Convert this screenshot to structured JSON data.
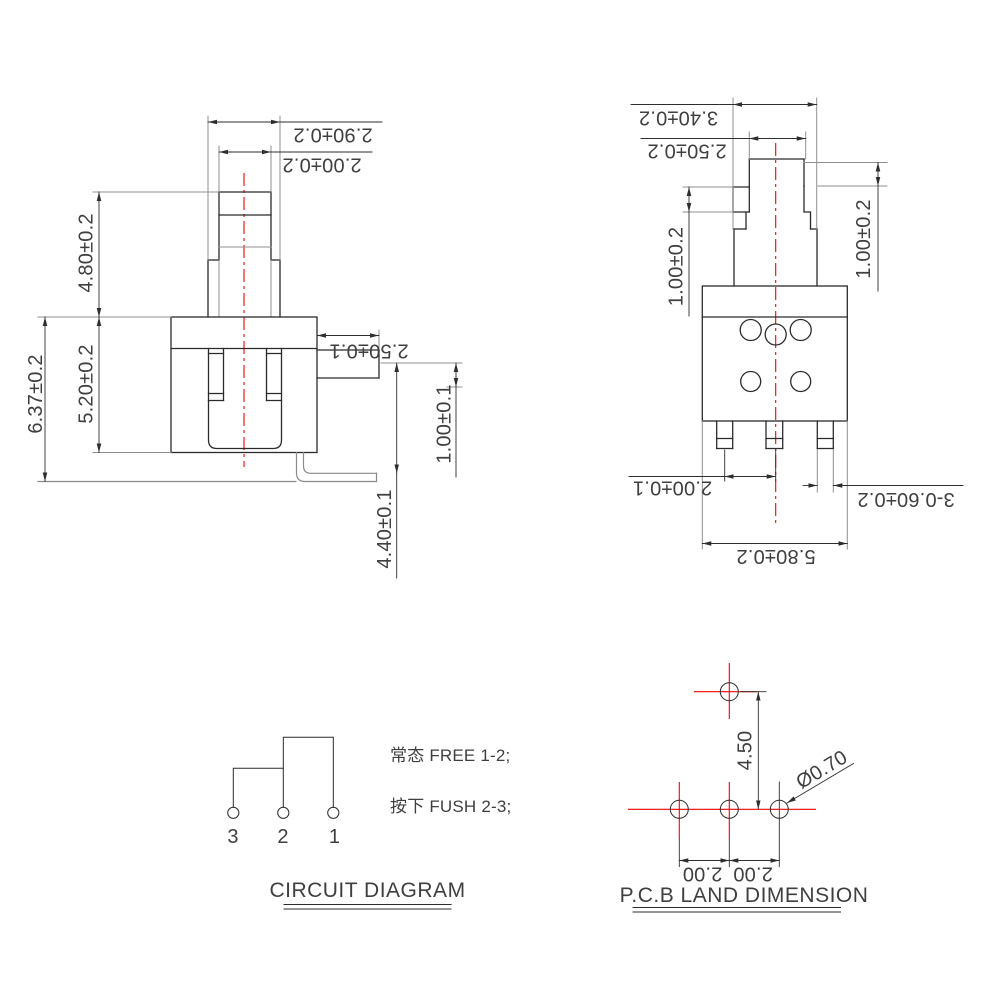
{
  "drawing": {
    "side_view": {
      "dim_plunger_outer_width": "2.90±0.2",
      "dim_plunger_inner_width": "2.00±0.2",
      "dim_plunger_height": "4.80±0.2",
      "dim_body_height": "5.20±0.2",
      "dim_total_height": "6.37±0.2",
      "dim_tab_length": "2.50±0.1",
      "dim_tab_offset": "1.00±0.1",
      "dim_lead_drop": "4.40±0.1"
    },
    "front_view": {
      "dim_boss_width": "3.40±0.2",
      "dim_cap_width": "2.50±0.2",
      "dim_cap_height_left": "1.00±0.2",
      "dim_cap_height_right": "1.00±0.2",
      "dim_pin_pitch": "2.00±0.1",
      "dim_pin_width": "3-0.60±0.2",
      "dim_body_width": "5.80±0.2"
    },
    "circuit_diagram": {
      "terminal_labels": [
        "3",
        "2",
        "1"
      ],
      "note_normal": "常态 FREE 1-2;",
      "note_pressed": "按下 FUSH 2-3;",
      "title": "CIRCUIT DIAGRAM"
    },
    "pcb_land": {
      "dim_row_pitch": "4.50",
      "dim_hole_diameter": "Ø0.70",
      "dim_pitch_left": "2.00",
      "dim_pitch_right": "2.00",
      "title": "P.C.B LAND DIMENSION"
    },
    "colors": {
      "outline": "#2b2b2b",
      "extension_line": "#8f8f8f",
      "centerline_red": "#f60200",
      "text": "#3f3f3f"
    }
  }
}
